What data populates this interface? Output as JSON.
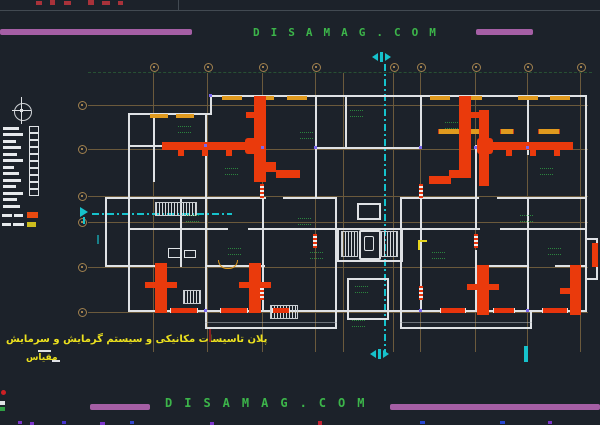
{
  "watermarks": {
    "top": "DISAMAG.COM",
    "bottom": "DISAMAG.COM"
  },
  "title_block": {
    "plan_title_fa": "پلان تاسیسات مکانیکی و سیستم گرمایش و سرمایش",
    "scale_label_fa": "مقیاس"
  },
  "legend": {
    "swatch_heating_color": "#e84a10",
    "swatch_secondary_color": "#cdbd1e"
  },
  "colors": {
    "background": "#1c222a",
    "wall_white": "#dfe2e5",
    "duct_red": "#ea3a0c",
    "window_orange": "#e09a1e",
    "grid_olive": "#6b5a3c",
    "grid_bubble": "#a0804e",
    "centerline_cyan": "#16c2cc",
    "watermark_green": "#3cb54a",
    "brand_bar_purple": "#a55fa5",
    "title_yellow": "#ece11e",
    "room_label_green": "#2f9e44",
    "grip_violet": "#7b68ee"
  }
}
